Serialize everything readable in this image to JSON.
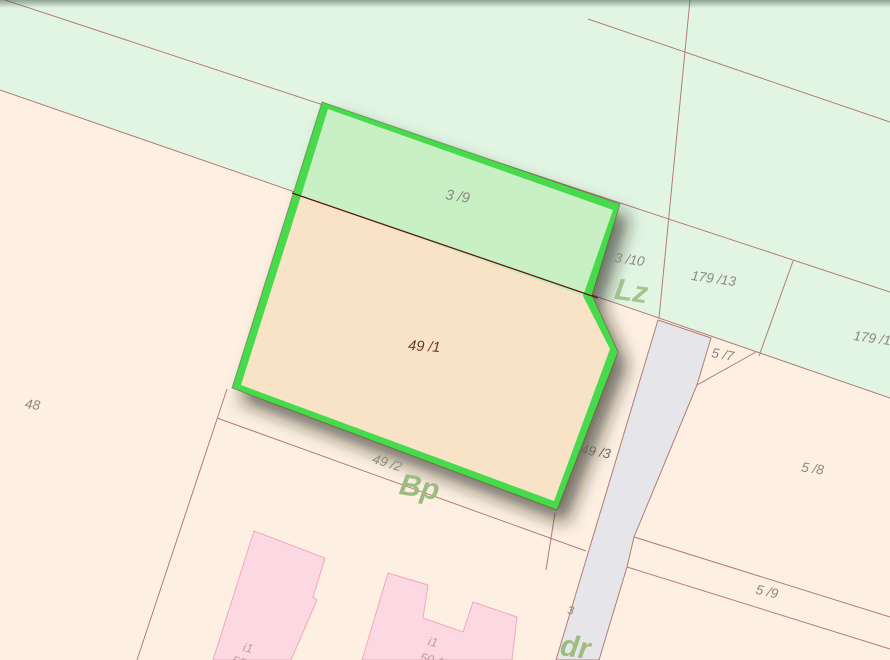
{
  "colors": {
    "mint": "#e2f5e3",
    "peach": "#fdf0e2",
    "parcel_green": "#c9efc5",
    "parcel_tan": "#f8e3c6",
    "highlight": "#46da4e",
    "road": "#e6e5e9",
    "building": "#fbd8e2",
    "building_stroke": "#f0a9bc",
    "line": "#b17c78",
    "inner_line": "#641710",
    "label_gray": "#8c8781",
    "label_maroon": "#6e352a",
    "label_dark": "#6f6a60",
    "label_olive": "#9cbc80",
    "label_pink": "#c49aa4"
  },
  "labels": {
    "p39": "3 /9",
    "p491": "49 /1",
    "p310": "3 /10",
    "lz": "Lz",
    "p17913": "179 /13",
    "p1791": "179 /1",
    "p57": "5 /7",
    "p48": "48",
    "p492": "49 /2",
    "bp": "Bp",
    "p493": "49 /3",
    "p58": "5 /8",
    "p59": "5 /9",
    "p3": "3",
    "dr": "dr",
    "i1_left": "i1",
    "i1_right": "i1",
    "n502": "50.2",
    "n501": "50.1"
  }
}
